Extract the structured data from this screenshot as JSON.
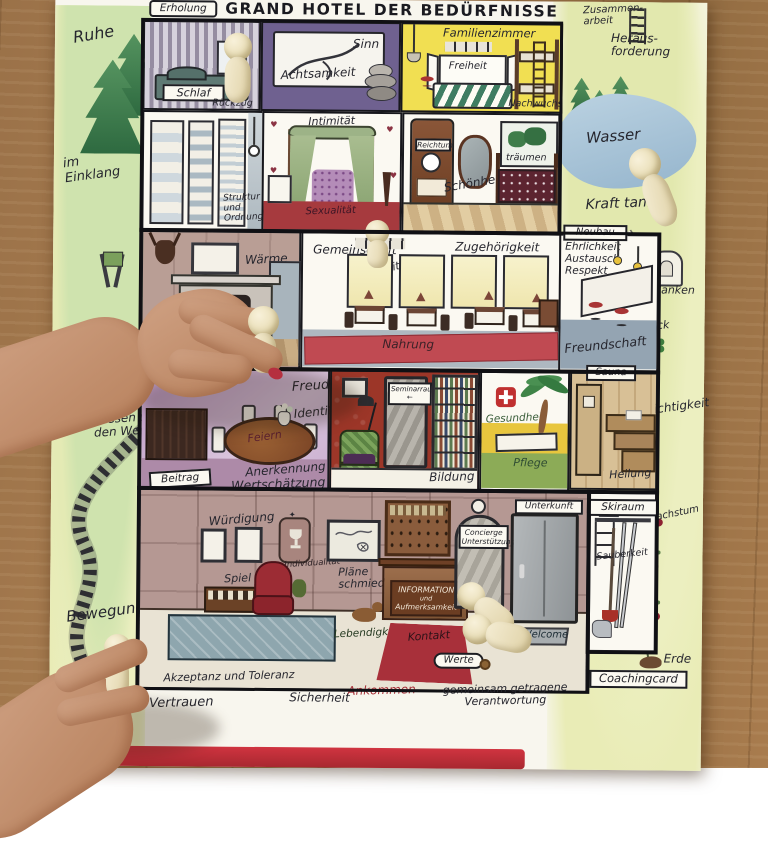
{
  "title": "GRAND HOTEL DER BEDÜRFNISSE",
  "labels": {
    "erholung": "Erholung",
    "ruhe": "Ruhe",
    "im_einklang": "im Einklang",
    "wissen_um_den_weg": "Wissen um den Weg",
    "bewegung": "Bewegung",
    "zusammen": "Zusammen-",
    "arbeit": "arbeit",
    "heraus": "Heraus-",
    "forderung": "forderung",
    "wasser": "Wasser",
    "kraft_tanken": "Kraft tanken",
    "gedanken": "Gedanken",
    "glueck": "Glück",
    "leichtigkeit": "Leichtigkeit",
    "wachstum": "Wachstum",
    "erde": "Erde"
  },
  "rooms": {
    "schlafzimmer": {
      "schlaf": "Schlaf",
      "rueckzug": "Rückzug"
    },
    "achtsamkeitszimmer": {
      "sinn": "Sinn",
      "achtsamkeit": "Achtsamkeit"
    },
    "familienzimmer": {
      "name": "Familienzimmer",
      "freiheit": "Freiheit",
      "nachwuchs": "Nachwuchs"
    },
    "ankleidezimmer": {
      "struktur_und_ordnung": "Struktur und Ordnung"
    },
    "intimzimmer": {
      "intimitaet": "Intimität",
      "sexualitaet": "Sexualität"
    },
    "spiegelzimmer": {
      "reichtum": "Reichtum",
      "schoenheit": "Schönheit",
      "traeumen": "träumen"
    },
    "kaminzimmer": {
      "waerme": "Wärme",
      "wc": "WC"
    },
    "speisesaal": {
      "gemeinschaft": "Gemeinschaft",
      "offenheit": "Offenheit",
      "zugehoerigkeit": "Zugehörigkeit",
      "nahrung": "Nahrung"
    },
    "bar": {
      "neubau": "Neubau",
      "ehrlichkeit": "Ehrlichkeit",
      "austausch": "Austausch",
      "respekt": "Respekt",
      "freundschaft": "Freundschaft"
    },
    "salon": {
      "freude": "Freude",
      "identitaet": "Identität",
      "feiern": "Feiern",
      "anerkennung": "Anerkennung",
      "wertschaetzung": "Wertschätzung",
      "beitrag": "Beitrag"
    },
    "bibliothek": {
      "seminarraum": "Seminarraum",
      "bildung": "Bildung"
    },
    "wellnessraum": {
      "gesundheit": "Gesundheit",
      "pflege": "Pflege"
    },
    "sauna": {
      "name": "Sauna",
      "heilung": "Heilung"
    },
    "lobby": {
      "wuerdigung": "Würdigung",
      "platz_finden": "Platz finden",
      "spiel": "Spiel",
      "individualitaet": "Individualität",
      "plaene_schmieden": "Pläne schmieden",
      "concierge": "Concierge",
      "unterstuetzung": "Unterstützung",
      "unterkunft": "Unterkunft",
      "information": "INFORMATION",
      "und": "und",
      "aufmerksamkeit": "Aufmerksamkeit",
      "lebendigkeit": "Lebendigkeit",
      "kontakt": "Kontakt",
      "welcome": "Welcome",
      "werte": "Werte",
      "ankommen": "Ankommen",
      "akzeptanz_und_toleranz": "Akzeptanz und Toleranz"
    },
    "skiraum": {
      "name": "Skiraum",
      "sauberkeit": "Sauberkeit"
    }
  },
  "footer": {
    "vertrauen": "Vertrauen",
    "sicherheit": "Sicherheit",
    "verantwortung": "gemeinsam getragene Verantwortung",
    "coachingcard": "Coachingcard"
  },
  "icons": {
    "heart": "♥",
    "arrow_left": "←",
    "x_mark": "×",
    "sparkle": "✦"
  },
  "pegs_visible": 8,
  "colors": {
    "peg": "#efe6c6",
    "familienzimmer_gelb": "#f1df52",
    "teppich_rot": "#bc4850",
    "salon_lila": "#b593bd",
    "bibliothek_rot": "#9c3327",
    "see_blau": "#a9c4d6",
    "wiese_gruen": "#e9ecb6",
    "holz_tisch": "#a97c4e"
  }
}
